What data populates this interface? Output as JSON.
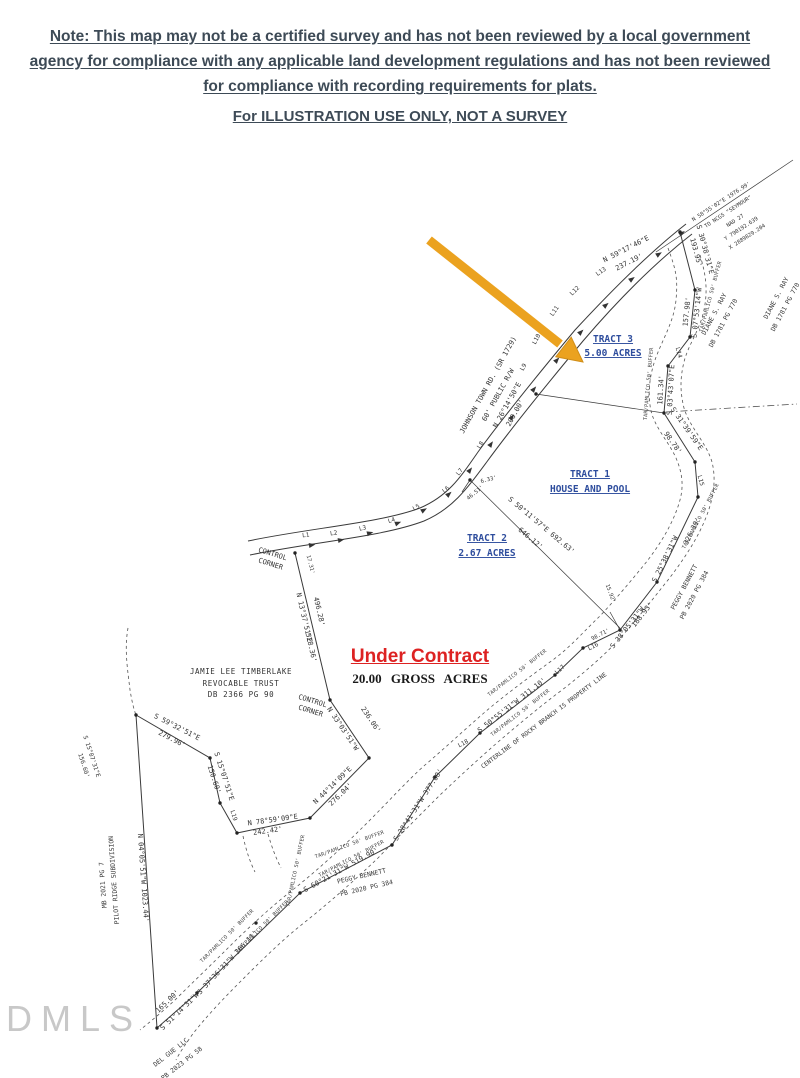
{
  "header": {
    "note": "Note: This map may not be a certified survey and has not been reviewed by a local government agency for compliance with any applicable land development regulations and has not been reviewed for compliance with recording requirements for plats.",
    "illustration": "For ILLUSTRATION USE ONLY, NOT A SURVEY"
  },
  "status": {
    "under_contract": "Under Contract",
    "gross_acres": "20.00 GROSS ACRES"
  },
  "tracts": {
    "t1": {
      "name": "TRACT 1",
      "desc": "HOUSE AND POOL"
    },
    "t2": {
      "name": "TRACT 2",
      "desc": "2.67 ACRES"
    },
    "t3": {
      "name": "TRACT 3",
      "desc": "5.00 ACRES"
    }
  },
  "road": {
    "name": "JOHNSON TOWN RD. (SR 1729)",
    "right_of_way": "60' PUBLIC R/W",
    "bearing": "N 26°14'50\"E",
    "distance": "200.00'"
  },
  "geodetic": {
    "tie": "N 58°55'02\"E 1976.99'",
    "to": "TO NCGS \"SEYMOUR\"",
    "datum": "NAD 27",
    "y": "Y 790192.639",
    "x": "X 2889829.204"
  },
  "adjoiners": {
    "timberlake": {
      "l1": "JAMIE LEE TIMBERLAKE",
      "l2": "REVOCABLE TRUST",
      "l3": "DB 2366 PG 90"
    },
    "ray": {
      "l1": "DIANE S. RAY",
      "l2": "DB 1781 PG 770"
    },
    "bennett": {
      "l1": "PEGGY BENNETT",
      "l2": "PB 2020 PG 384"
    },
    "pilot_ridge": {
      "l1": "PILOT RIDGE SUBDIVISION",
      "l2": "MB 2021 PG 7"
    },
    "del_gue": {
      "l1": "DEL GUE LLC",
      "l2": "PB 2023 PG 58"
    }
  },
  "control_corner": {
    "l1": "CONTROL",
    "l2": "CORNER"
  },
  "buffer_label": "TAR/PAMLICO 50' BUFFER",
  "centerline_label": "CENTERLINE OF ROCKY BRANCH IS PROPERTY LINE",
  "bearings": {
    "n5917": {
      "b": "N 59°17'46\"E",
      "d": "237.19'"
    },
    "s3038": {
      "b": "S 30°38'31\"E",
      "d": "193.95'"
    },
    "s0753": {
      "b": "S 07°53'14\"W",
      "d": "157.98'"
    },
    "s0343": {
      "b": "S 03°43'07\"E",
      "d": "161.34'"
    },
    "s3139": {
      "b": "S 31°39'59\"E",
      "d": "98.78'"
    },
    "s2538": {
      "b": "S 25°38'31\"W",
      "d": "326.30'"
    },
    "s3805": {
      "b": "S 38°05'31\"W",
      "d": "188.93'"
    },
    "s5055": {
      "bd": "S 50°55'31\"W 311.10'"
    },
    "s2841": {
      "bd": "S 28°41'31\"W 377.00'"
    },
    "s6021": {
      "bd": "S 60°21'31\"W 519.90'"
    },
    "s3736": {
      "bd": "S 37°36'31\"W 366.11'"
    },
    "s5114": {
      "b": "S 51°14'31\"W",
      "d": "165.00'"
    },
    "n0405": {
      "bd": "N 04°05'51\"W 1023.44'"
    },
    "n1337": {
      "b": "N 13°37'51\"E",
      "d1": "496.28'",
      "d2": "528.36'"
    },
    "n3303": {
      "b": "N 33°03'51\"W",
      "d": "236.06'"
    },
    "n4414": {
      "b": "N 44°14'09\"E",
      "d": "276.04'"
    },
    "n7859": {
      "b": "N 78°59'09\"E",
      "d": "242.42'"
    },
    "s5932": {
      "b": "S 59°32'51\"E",
      "d": "279.96'"
    },
    "s1507": {
      "b": "S 15°07'51\"E",
      "d": "150.60'"
    },
    "s5011": {
      "bd": "S 50°11'57\"E 692.63'",
      "d2": "646.12'"
    },
    "s1507b": {
      "b": "S 15°07'31\"E",
      "d": "156.60'"
    },
    "m1": "6.33'",
    "m2": "46.51'",
    "m3": "17.31'",
    "m4": "15.92'",
    "m5": "98.71'"
  },
  "segment_labels": [
    "L1",
    "L2",
    "L3",
    "L4",
    "L5",
    "L6",
    "L7",
    "L8",
    "L9",
    "L10",
    "L11",
    "L12",
    "L13",
    "L14",
    "L15",
    "L16",
    "L17",
    "L18",
    "L19"
  ],
  "watermark": "DMLS",
  "colors": {
    "arrow": "#EBA21F",
    "tract_blue": "#2E4D9D",
    "contract_red": "#DD2222",
    "header_ink": "#3D4A56"
  }
}
